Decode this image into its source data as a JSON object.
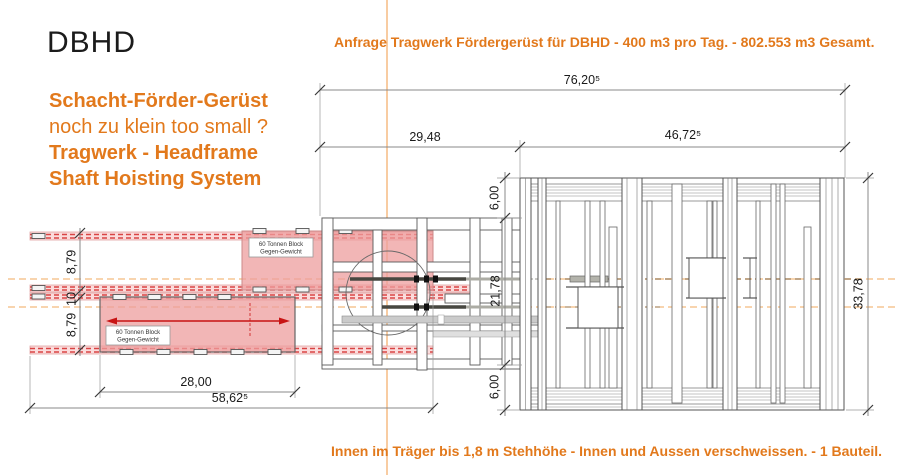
{
  "logo": "DBHD",
  "intro": {
    "line1": "Schacht-Förder-Gerüst",
    "line2": "noch zu klein too small ?",
    "line3": "Tragwerk - Headframe",
    "line4": "Shaft Hoisting System"
  },
  "header_note": "Anfrage Tragwerk Fördergerüst für DBHD - 400 m3 pro Tag. - 802.553 m3  Gesamt.",
  "footer_note": "Innen im Träger bis 1,8 m Stehhöhe - Innen und Aussen verschweissen. - 1 Bauteil.",
  "dimensions": {
    "total_width": "76,20⁵",
    "left_span": "29,48",
    "right_span": "46,72⁵",
    "frame_top": "6,00",
    "frame_mid": "21,78",
    "frame_bottom": "6,00",
    "frame_total": "33,78",
    "rail_top": "8,79",
    "rail_gap": "10",
    "rail_bottom": "8,79",
    "block_length": "28,00",
    "overall_left": "58,62⁵"
  },
  "counterweight_label": {
    "line1": "60 Tonnen Block",
    "line2": "Gegen-Gewicht"
  },
  "colors": {
    "accent_orange": "#E2791C",
    "guide_orange": "#F2A95C",
    "rail_red": "#D94444",
    "block_pink": "#F0A8A8",
    "line_gray": "#5A5A5A"
  }
}
